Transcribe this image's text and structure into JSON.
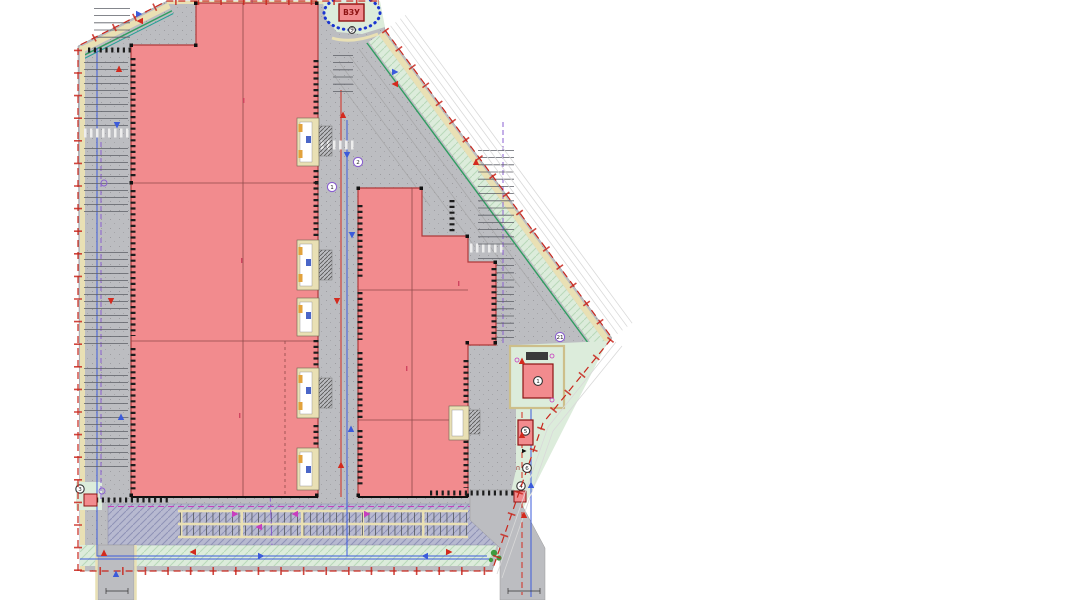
{
  "plan": {
    "vzu_label": "ВЗУ",
    "vzu_note": "9",
    "markers": {
      "road_a": "1",
      "road_b": "2",
      "substation": "1",
      "pump_unit": "5",
      "gate_unit": "4",
      "landscape": "6",
      "landscape_prefix": "п",
      "corner_unit": "3",
      "path_point": "21"
    }
  },
  "colors": {
    "building": "#f28b8e",
    "building_stroke": "#b03a3a",
    "pavement": "#bcbdc1",
    "tan": "#e9e0b4",
    "green_light": "#dcecdb",
    "green_line": "#2f9e60",
    "parking_hatch_bg": "#b7b9d0",
    "boundary_red": "#c8271d",
    "utility_blue": "#3b5bdb",
    "utility_purple": "#8a5fd0",
    "dock_tick": "#1c1c1c",
    "ellipse_blue": "#1a35d0",
    "tree_green": "#3f9b3f"
  },
  "icons": {
    "vzu_circle": "blue-dotted-ellipse-icon",
    "survey": "survey-point-icon",
    "arrow": "traffic-arrow-icon"
  }
}
